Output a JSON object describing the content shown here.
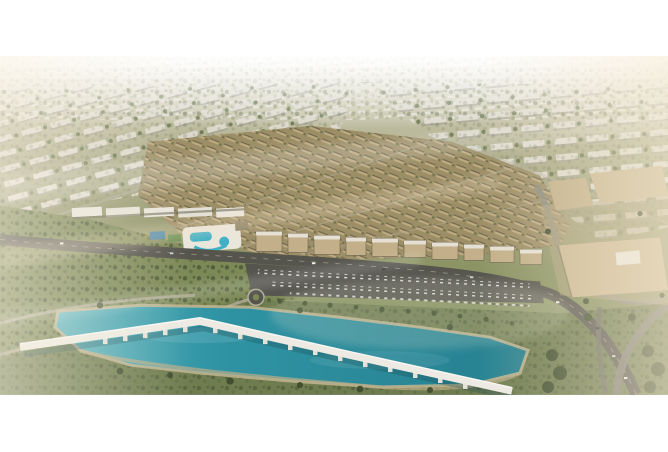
{
  "page": {
    "background": "#ffffff"
  },
  "image": {
    "alt": "Aerial rendering of a master-planned residential community: a dense central cluster of sand-colored townhouses and mid-rise apartment buildings, surrounded by rows of low white suburban blocks fading into haze, a curved landscaped park with winding paths on the left, a tree-lined boulevard with a car-filled parking strip and roundabout, a turquoise lagoon crossed by a long white pedestrian bridge on piers, and a flat-roofed retail complex with looping roads at the lower right, lit by warm hazy sunlight",
    "type": "architectural-aerial-render"
  },
  "palette": {
    "white": "#ffffff",
    "haze_top": "#f4f1e8",
    "distant_building": "#e2dfd3",
    "slab_white": "#dcd9cc",
    "slab_shadow": "#a5a293",
    "greenery": "#6d7a50",
    "tree_dark": "#42502f",
    "cluster_ground": "#9c8e66",
    "cluster_building": "#bfac82",
    "cluster_roof": "#5f5741",
    "retail_white": "#e9e6db",
    "road_dark": "#55544d",
    "road_mid": "#7b7a70",
    "path_light": "#b5ae9a",
    "park_green": "#7c8856",
    "bank_green": "#6f7c4f",
    "sand": "#c2b58f",
    "lagoon_light": "#58b2bd",
    "lagoon": "#2f93a3",
    "lagoon_deep": "#26808f",
    "bridge_white": "#eceae2",
    "bridge_pier": "#e4e2d8",
    "bridge_shadow": "#1c4a52",
    "mall_roof": "#cbb892",
    "pool_blue": "#3fb0c5",
    "court_blue": "#3d7fa6",
    "warm_haze": "#f6e8cd",
    "car_light": "#dcdcd8",
    "car_dark": "#55504a"
  }
}
